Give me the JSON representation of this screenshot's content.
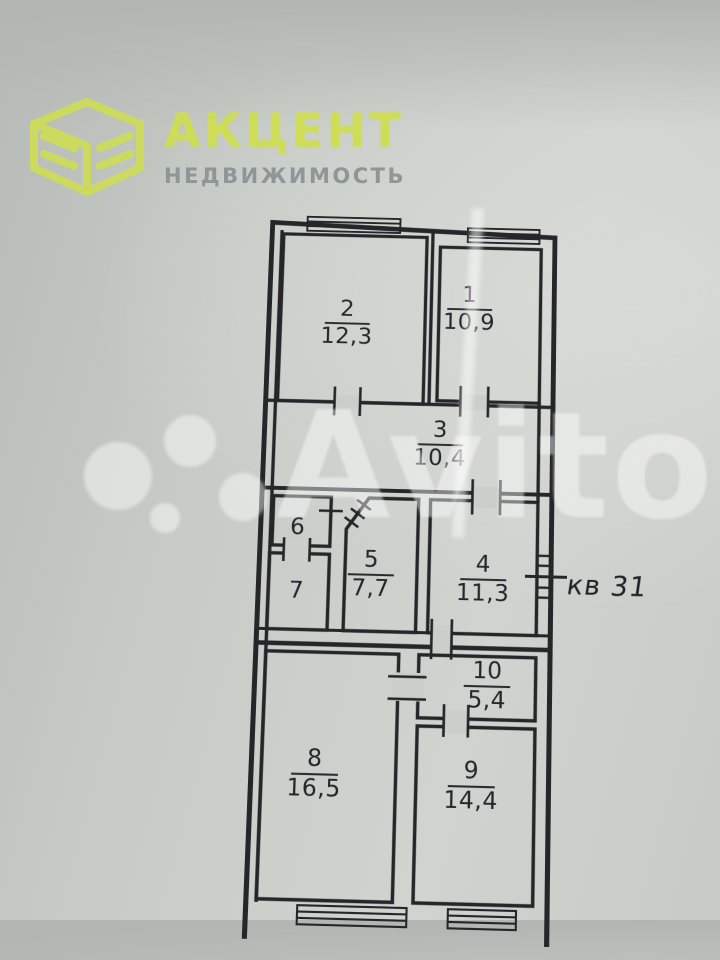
{
  "logo": {
    "brand": "АКЦЕНТ",
    "subtitle": "НЕДВИЖИМОСТЬ",
    "brand_color": "#cedd55",
    "subtitle_color": "#8f9697",
    "icon": "cube-book-icon"
  },
  "watermark": {
    "text": "Avito",
    "color": "#ffffff"
  },
  "plan": {
    "apartment_label": "кв 31",
    "wall_color": "#26262a",
    "paper_color": "#c9cdc8",
    "rooms": [
      {
        "number": "1",
        "area": "10,9"
      },
      {
        "number": "2",
        "area": "12,3"
      },
      {
        "number": "3",
        "area": "10,4"
      },
      {
        "number": "4",
        "area": "11,3"
      },
      {
        "number": "5",
        "area": "7,7"
      },
      {
        "number": "6",
        "area": ""
      },
      {
        "number": "7",
        "area": ""
      },
      {
        "number": "8",
        "area": "16,5"
      },
      {
        "number": "9",
        "area": "14,4"
      },
      {
        "number": "10",
        "area": "5,4"
      }
    ]
  }
}
